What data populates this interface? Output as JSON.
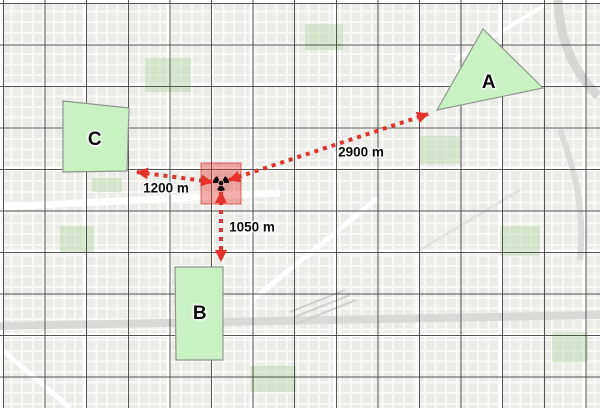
{
  "map": {
    "description": "grayscale street basemap with dark graticule grid overlay",
    "grid_overlay": true
  },
  "zones": [
    {
      "label": "A"
    },
    {
      "label": "B"
    },
    {
      "label": "C"
    }
  ],
  "hazard_marker": {
    "icon": "radiation-icon",
    "fill_color": "rgba(229,49,43,0.40)"
  },
  "measurements": [
    {
      "to_zone": "A",
      "distance": "2900 m"
    },
    {
      "to_zone": "B",
      "distance": "1050 m"
    },
    {
      "to_zone": "C",
      "distance": "1200 m"
    }
  ],
  "colors": {
    "zone_fill": "#c9f2c3",
    "zone_border": "#8f978f",
    "measurement_red": "#e8312b",
    "grid_line": "#3e3e3e",
    "basemap_block": "#ebebe8",
    "basemap_street": "#ffffff"
  }
}
